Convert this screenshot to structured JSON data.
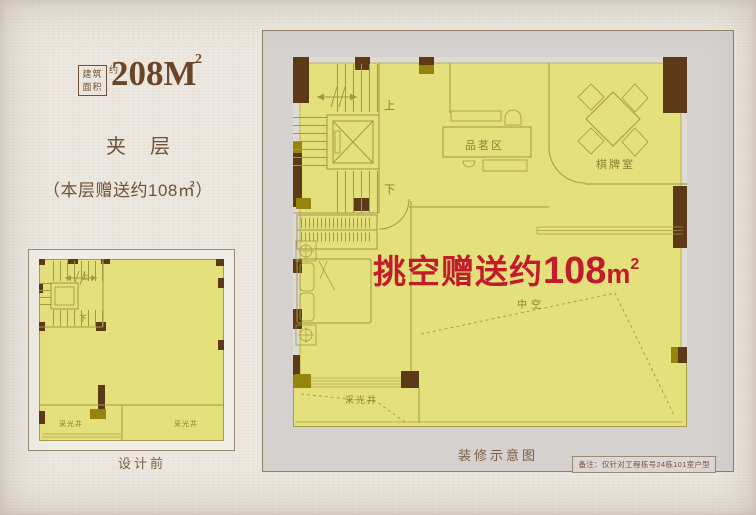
{
  "colors": {
    "page_bg": "#ebe7df",
    "floor_yellow": "#e4e07b",
    "wall_dark_brown": "#5d3a17",
    "wall_olive": "#97840b",
    "plan_line": "#a39945",
    "panel_gray": "#d4d1cf",
    "accent_red": "#c11b2c",
    "text_brown": "#6e5137"
  },
  "header": {
    "area_row1": "建筑",
    "area_row2": "面积",
    "area_approx": "约",
    "area_value": "208M",
    "area_sup": "2",
    "mezzanine": "夹层",
    "bonus": "（本层赠送约108㎡）"
  },
  "before_plan": {
    "up": "上",
    "down": "下",
    "light_well_left": "采光井",
    "light_well_right": "采光井",
    "caption": "设计前"
  },
  "after_plan": {
    "up": "上",
    "down": "下",
    "tea_area": "品茗区",
    "chess_room": "棋牌室",
    "void_label": "中空",
    "light_well": "采光井",
    "highlight_text": "挑空赠送约",
    "highlight_value": "108",
    "highlight_unit": "m",
    "highlight_sup": "2",
    "caption": "装修示意图",
    "note": "备注：仅针对工程栋号24栋101室户型"
  }
}
